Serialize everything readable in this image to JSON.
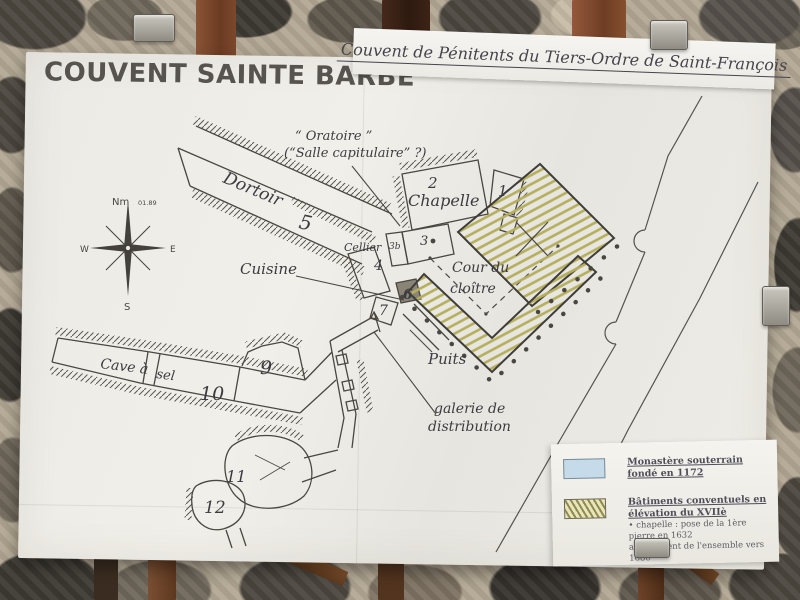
{
  "board": {
    "title": "COUVENT SAINTE BARBE",
    "subtitle": "Couvent de Pénitents du Tiers-Ordre de Saint-François"
  },
  "plan": {
    "labels": {
      "oratoire1": "“ Oratoire ”",
      "oratoire2": "(“Salle capitulaire” ?)",
      "dortoir": "Dortoir",
      "chapelle": "Chapelle",
      "cellier": "Cellier",
      "cuisine": "Cuisine",
      "cour1": "Cour du",
      "cour2": "cloître",
      "cave1": "Cave à",
      "cave2": "sel",
      "puits": "Puits",
      "galerie1": "galerie de",
      "galerie2": "distribution"
    },
    "numbers": {
      "n1": "1",
      "n2": "2",
      "n3": "3",
      "n3b": "3b",
      "n4": "4",
      "n5": "5",
      "n6": "6",
      "n7": "7",
      "n9": "9",
      "n10": "10",
      "n11": "11",
      "n12": "12"
    },
    "compass": {
      "n": "Nm",
      "note": "01.89",
      "w": "W",
      "e": "E",
      "s": "S"
    }
  },
  "legend": {
    "underground": {
      "label": "Monastère souterrain fondé en 1172"
    },
    "elevation": {
      "label": "Bâtiments conventuels en élévation du XVIIè",
      "detail1": "• chapelle : pose de la 1ère pierre en 1632",
      "detail2": "achèvement de l'ensemble vers 1680"
    }
  },
  "colors": {
    "underground_swatch": "#c6dbe9",
    "elevation_hatch": "#b5ae5a",
    "ink": "#4a4741"
  }
}
